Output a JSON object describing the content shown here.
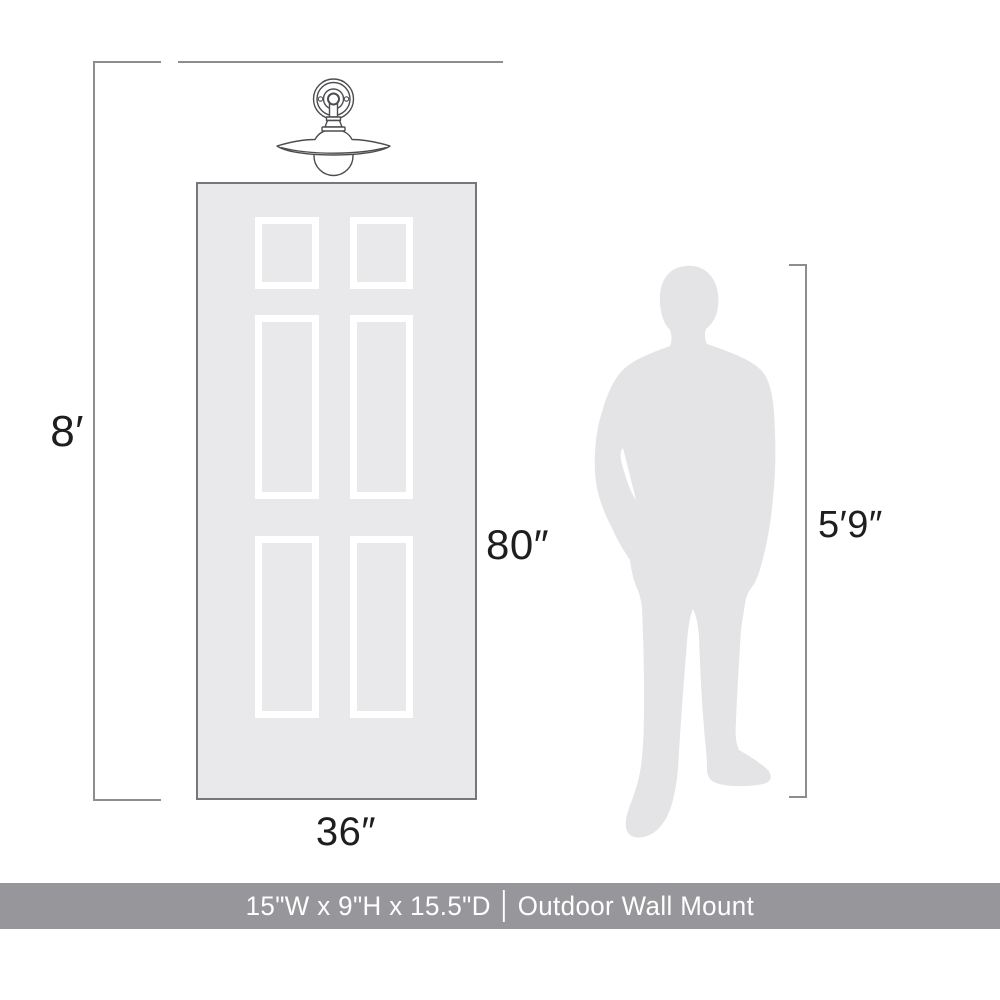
{
  "diagram": {
    "wall": {
      "height_label": "8′"
    },
    "door": {
      "height_label": "80″",
      "width_label": "36″"
    },
    "person": {
      "height_label": "5′9″"
    }
  },
  "banner": {
    "dimensions": "15\"W x 9\"H x 15.5\"D",
    "separator": "|",
    "mount_type": "Outdoor Wall Mount"
  },
  "icons": {
    "fixture": "wall-sconce-line-art-icon",
    "person": "male-silhouette",
    "door": "six-panel-door-graphic"
  },
  "theme": {
    "background": "#ffffff",
    "line-color": "#8d8d91",
    "door-border": "#77777b",
    "door-fill": "#e9e9eb",
    "panel-frame": "#ffffff",
    "person-fill": "#e4e4e6",
    "fixture-stroke": "#4d4d51",
    "banner-bg": "#97979b",
    "banner-text": "#ffffff",
    "label-color": "#1e1e20"
  }
}
